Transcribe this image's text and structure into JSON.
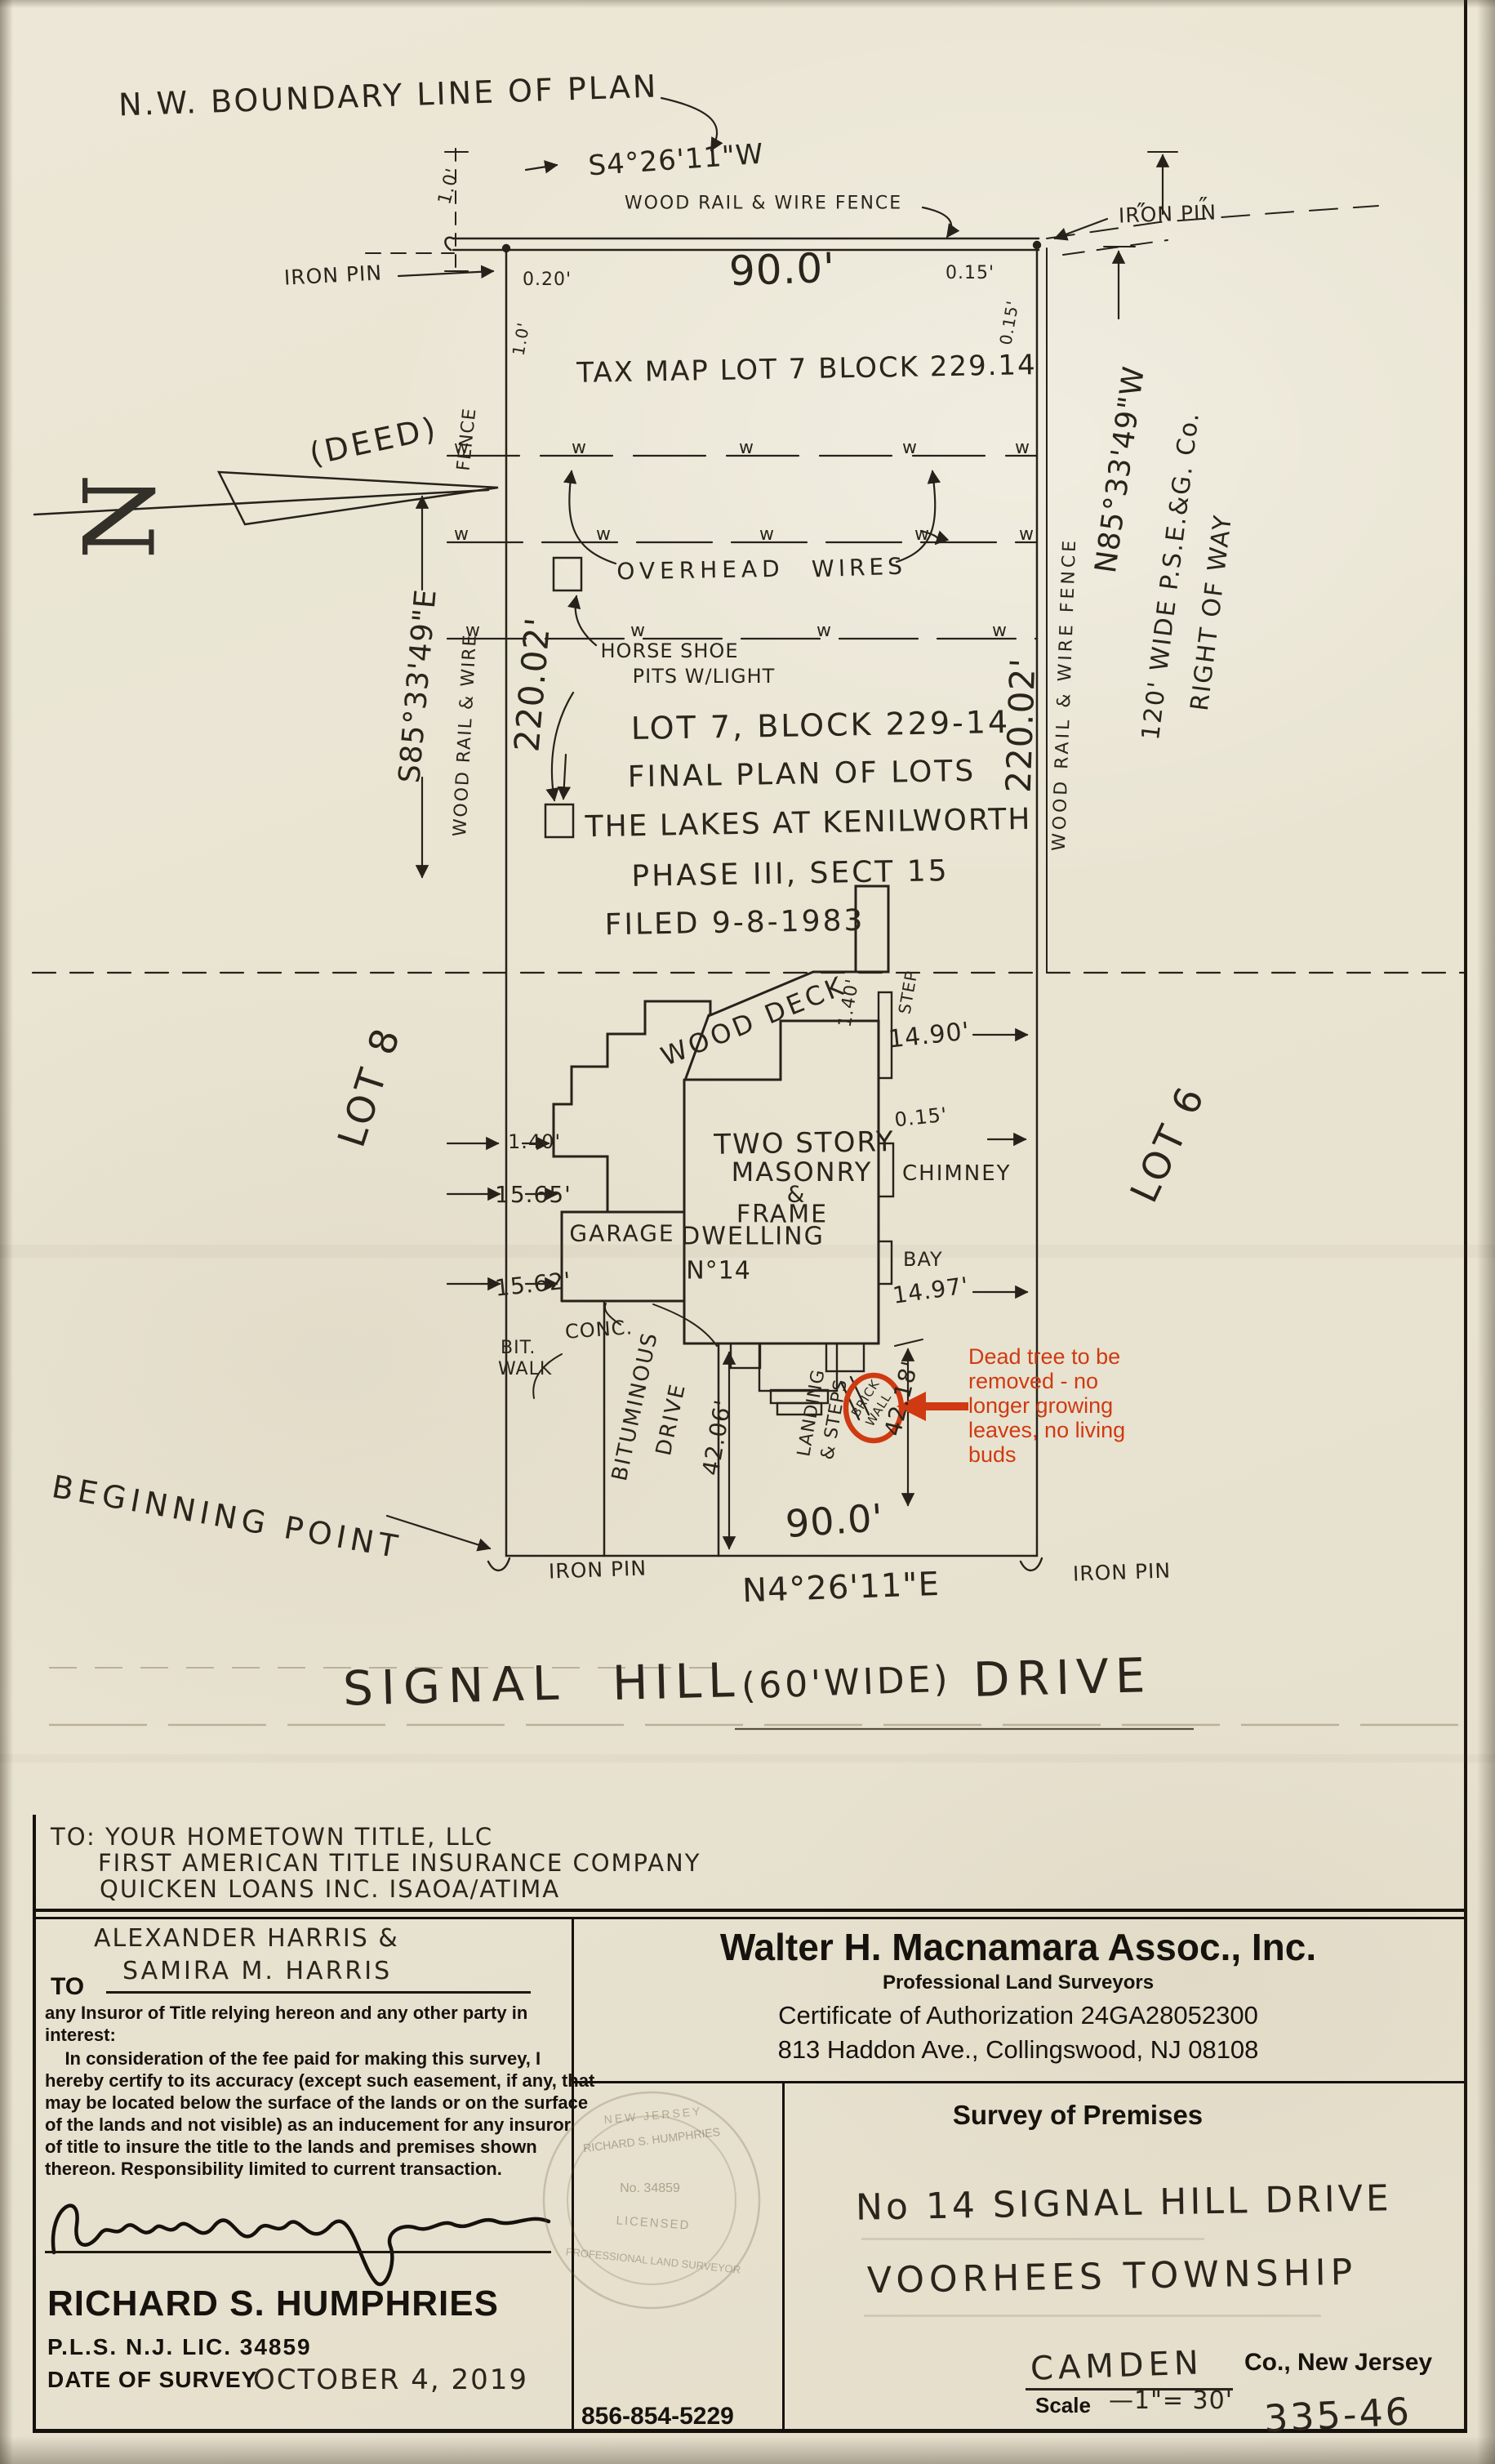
{
  "plot": {
    "nw_boundary": "N.W. BOUNDARY LINE OF PLAN",
    "bearing_top": "S4°26'11\"W",
    "fence_top": "WOOD RAIL & WIRE FENCE",
    "iron_pin": "IRON PIN",
    "ditto": "″",
    "dim_020": "0.20'",
    "dim_90_top": "90.0'",
    "dim_015_h": "0.15'",
    "dim_015_v": "0.15'",
    "dim_10_top": "1.0'",
    "dim_10_left": "1.0'",
    "tax_map": "TAX MAP LOT 7 BLOCK 229.14",
    "deed": "(DEED)",
    "north_letter": "N",
    "fence_left": "FENCE",
    "wood_rail_wire_left": "WOOD RAIL & WIRE",
    "bearing_left": "S85°33'49\"E",
    "dim_220_left": "220.02'",
    "overhead": "OVERHEAD",
    "wires": "WIRES",
    "wire_mark": "w",
    "horse_shoe_1": "HORSE SHOE",
    "horse_shoe_2": "PITS W/LIGHT",
    "lot_note_1": "LOT 7, BLOCK 229-14",
    "lot_note_2": "FINAL PLAN OF LOTS",
    "lot_note_3": "THE LAKES AT KENILWORTH",
    "lot_note_4": "PHASE III, SECT 15",
    "lot_note_5": "FILED 9-8-1983",
    "dim_220_right": "220.02'",
    "fence_right": "WOOD RAIL & WIRE FENCE",
    "bearing_right": "N85°33'49\"W",
    "row_line_1": "120' WIDE P.S.E.&G. Co.",
    "row_line_2": "RIGHT OF WAY",
    "lot8": "LOT 8",
    "lot6": "LOT 6",
    "wood_deck": "WOOD DECK",
    "dim_140_deck": "1.40'",
    "step": "STEP",
    "dim_1490": "14.90'",
    "dim_015_chimney": "0.15'",
    "house_line_1": "TWO STORY",
    "house_line_2": "MASONRY",
    "house_line_3": "&",
    "house_line_4": "FRAME",
    "house_line_5": "DWELLING",
    "house_line_6": "N°14",
    "garage": "GARAGE",
    "chimney": "CHIMNEY",
    "bay": "BAY",
    "dim_1497": "14.97'",
    "dim_140_left": "1.40'",
    "dim_1565": "15.65'",
    "dim_1562": "15.62'",
    "conc": "CONC.",
    "bit_walk_1": "BIT.",
    "bit_walk_2": "WALK",
    "bituminous_1": "BITUMINOUS",
    "bituminous_2": "DRIVE",
    "dim_4206": "42.06'",
    "landing_1": "LANDING",
    "landing_2": "& STEPS",
    "brick_1": "BRICK",
    "brick_2": "WALL",
    "dim_4218": "42.18'",
    "dim_90_bottom": "90.0'",
    "beginning_point": "BEGINNING POINT",
    "bearing_bottom": "N4°26'11\"E",
    "street_parts": [
      "SIGNAL",
      "HILL",
      "(60'WIDE)",
      "DRIVE"
    ]
  },
  "annotation": {
    "color": "#cf3a12",
    "lines": [
      "Dead tree to be",
      "removed - no",
      "longer growing",
      "leaves, no living",
      "buds"
    ]
  },
  "recipients": {
    "line1": "TO: YOUR HOMETOWN TITLE, LLC",
    "line2": "FIRST AMERICAN TITLE INSURANCE COMPANY",
    "line3": "QUICKEN LOANS INC.  ISAOA/ATIMA"
  },
  "certification": {
    "to_label": "TO",
    "name1": "ALEXANDER HARRIS &",
    "name2": "SAMIRA M. HARRIS",
    "body": [
      "any Insuror of Title relying hereon and any other party in",
      "interest:",
      "    In consideration of the fee paid for making this survey, I",
      "hereby certify to its accuracy (except such easement, if any, that",
      "may be located below the surface of the lands or on the surface",
      "of the lands and not visible) as an inducement for any insuror",
      "of title to insure the title to the lands and premises shown",
      "thereon. Responsibility limited to current transaction."
    ],
    "surveyor_name": "RICHARD S. HUMPHRIES",
    "license": "P.L.S. N.J. LIC. 34859",
    "date_label": "DATE OF SURVEY",
    "date_value": "OCTOBER 4, 2019"
  },
  "firm": {
    "name": "Walter H. Macnamara Assoc., Inc.",
    "subtitle": "Professional Land Surveyors",
    "cert": "Certificate of Authorization 24GA28052300",
    "address": "813 Haddon Ave., Collingswood, NJ 08108",
    "phone": "856-854-5229"
  },
  "premises": {
    "heading": "Survey of Premises",
    "line1": "No 14 SIGNAL HILL DRIVE",
    "line2": "VOORHEES TOWNSHIP",
    "county": "CAMDEN",
    "county_suffix": "Co., New Jersey",
    "scale_label": "Scale",
    "scale_value": "—1\"= 30'",
    "job_number": "335-46"
  },
  "seal": {
    "name": "RICHARD S. HUMPHRIES",
    "number": "No. 34859",
    "licensed": "LICENSED",
    "profession": "PROFESSIONAL LAND SURVEYOR",
    "state": "NEW JERSEY"
  }
}
